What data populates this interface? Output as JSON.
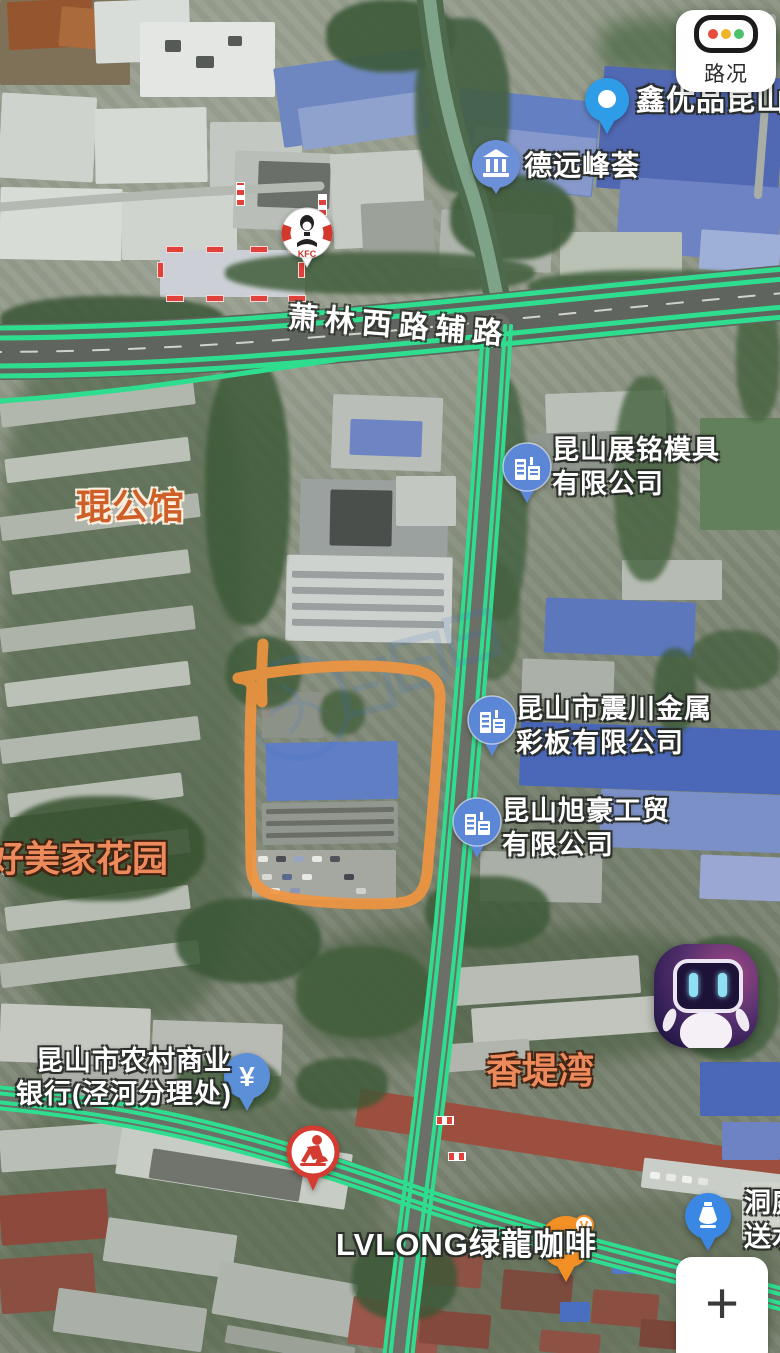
{
  "controls": {
    "traffic_label": "路况",
    "zoom_in_label": "+",
    "coffee_badge": "V"
  },
  "road_labels": {
    "main_road": "萧林西路辅路"
  },
  "area_labels": {
    "kungongguan": "琨公馆",
    "haomeijia": "好美家花园",
    "xiangtiwan": "香堤湾"
  },
  "pois": {
    "xinyoupin": {
      "label": "鑫优品昆山仓"
    },
    "deyuan": {
      "label": "德远峰荟"
    },
    "zhanming": {
      "line1": "昆山展铭模具",
      "line2": "有限公司"
    },
    "zhenchuan": {
      "line1": "昆山市震川金属",
      "line2": "彩板有限公司"
    },
    "xuhao": {
      "line1": "昆山旭豪工贸",
      "line2": "有限公司"
    },
    "bank": {
      "line1": "昆山市农村商业",
      "line2": "银行(泾河分理处)",
      "pin_symbol": "¥"
    },
    "lvlong": {
      "label": "LVLONG绿龍咖啡"
    },
    "dongting": {
      "line1": "洞庭山",
      "line2": "送水"
    },
    "kfc": {
      "label": "KFC"
    }
  },
  "colors": {
    "traffic_green": "#2ede8e",
    "annotation_orange": "#f2953f",
    "company_pin_blue": "#5c86d6",
    "area_label_orange": "#ec8a5c",
    "traffic_light": [
      "#e84c3c",
      "#f0b429",
      "#4cc06a"
    ]
  }
}
